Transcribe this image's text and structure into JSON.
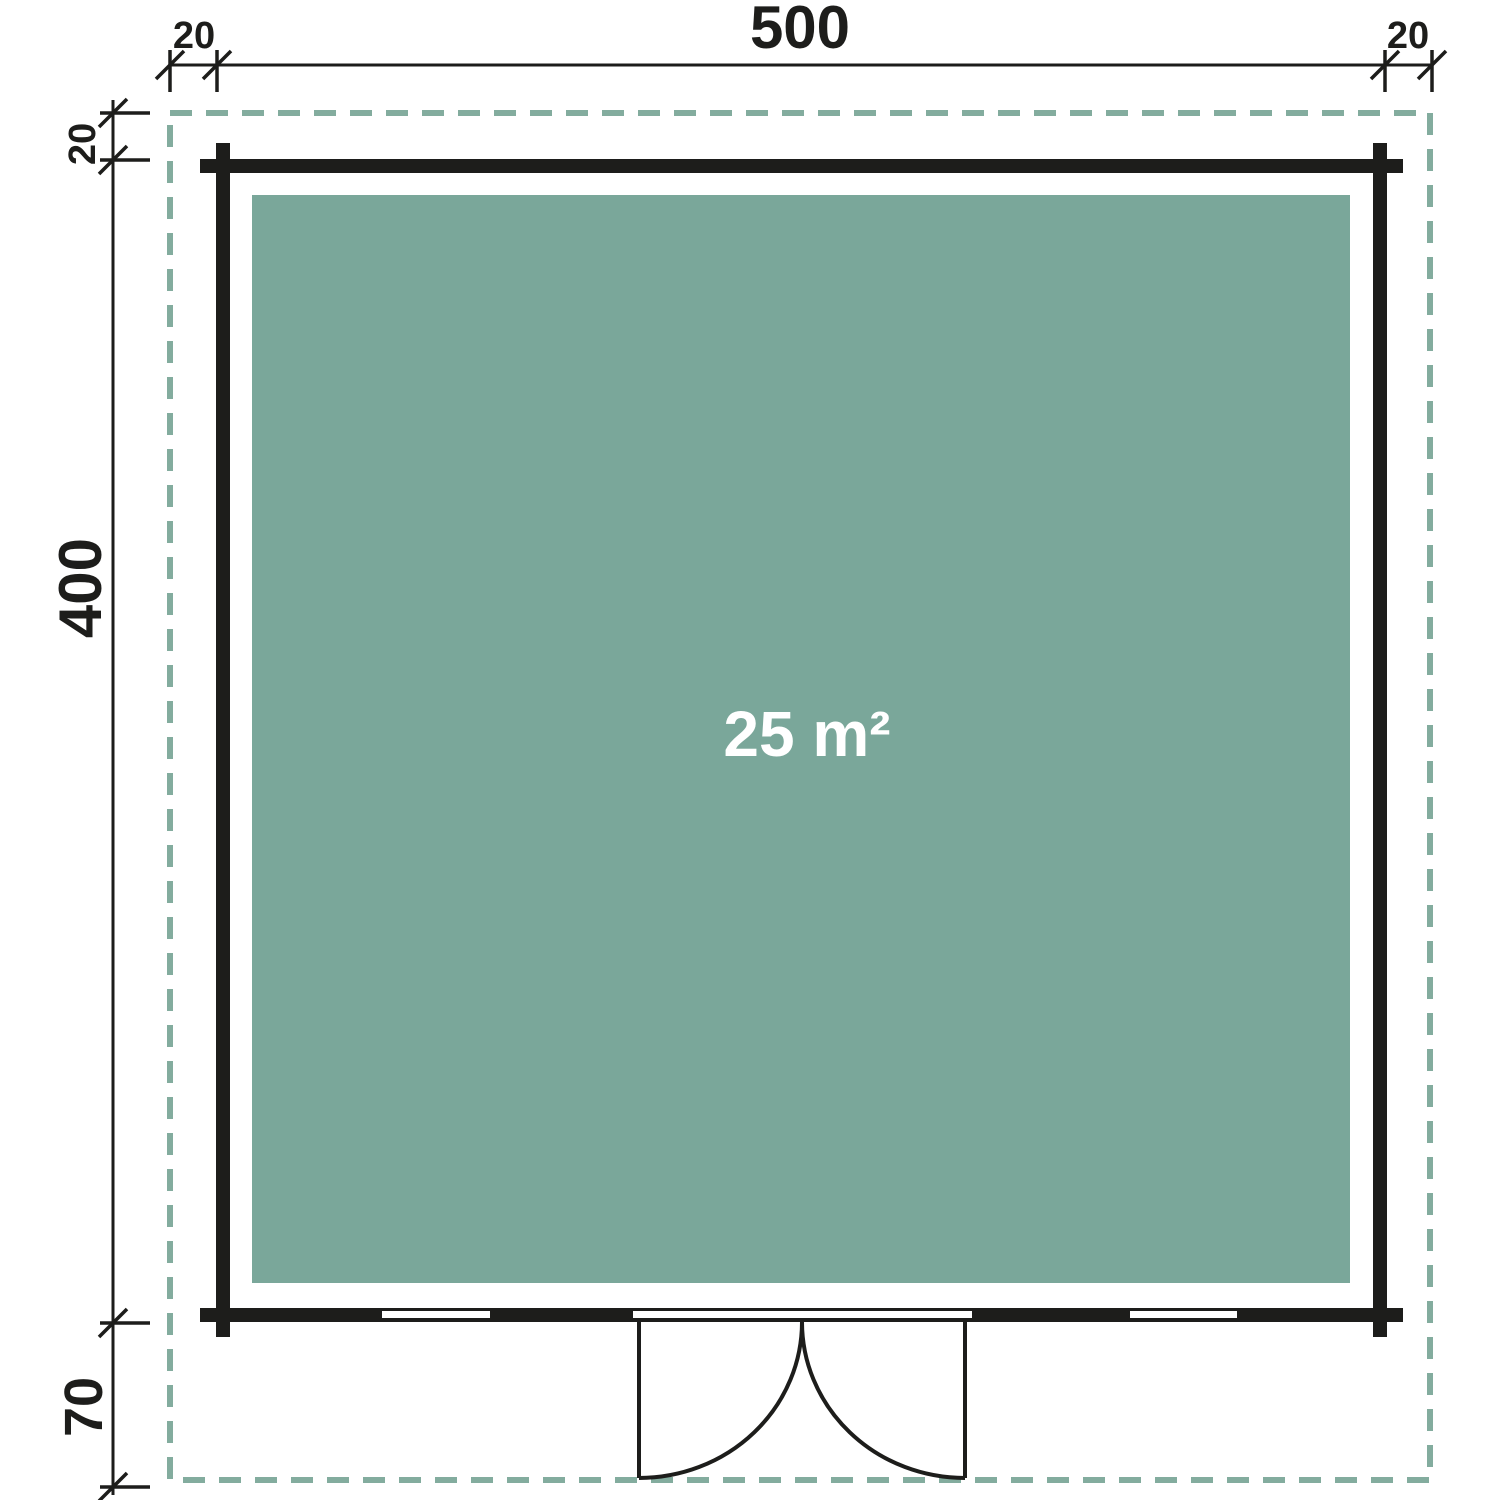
{
  "plan": {
    "area_label": "25 m²",
    "dimensions": {
      "width": "500",
      "depth": "400",
      "overhang_top_left": "20",
      "overhang_top_right": "20",
      "overhang_left_top": "20",
      "front_porch_depth": "70"
    },
    "colors": {
      "wall": "#1d1d1b",
      "floor": "#7AA79A",
      "overhang_dash": "#83AC9E",
      "dimension_ink": "#1d1d1b",
      "area_text": "#ffffff",
      "background": "#ffffff"
    }
  }
}
